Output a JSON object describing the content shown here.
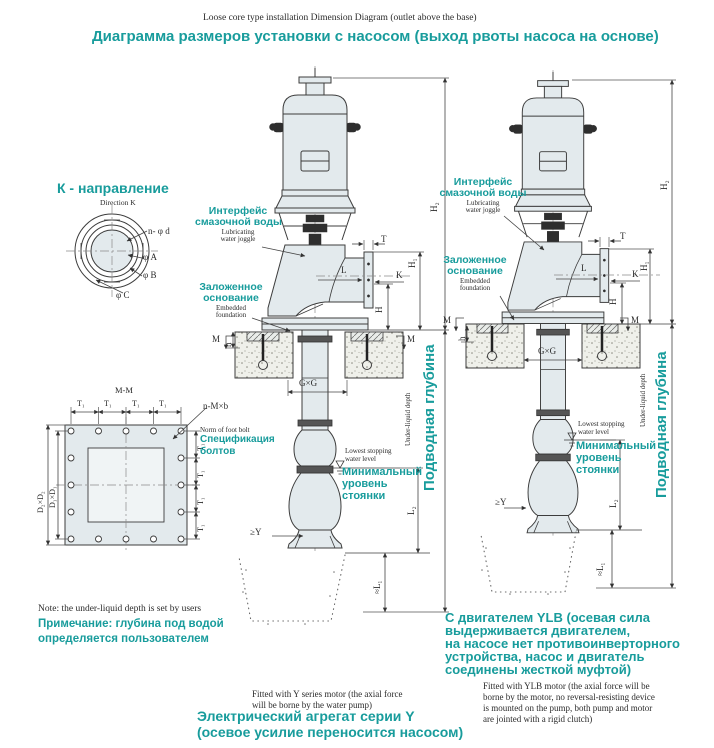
{
  "colors": {
    "accent": "#189c9c",
    "line": "#3c3c3c"
  },
  "title": {
    "en": "Loose core type installation Dimension Diagram (outlet above the base)",
    "ru": "Диаграмма размеров установки с насосом (выход рвоты насоса на основе)"
  },
  "direction_view": {
    "heading_ru": "К - направление",
    "heading_en": "Direction K",
    "bolt_holes": "n- φ d",
    "dia_a": "φ A",
    "dia_b": "φ B",
    "dia_c": "φ C"
  },
  "plan_view": {
    "heading": "M-M",
    "t1": "T₁",
    "d2d2": "D₂×D₂",
    "d1d1": "D₁×D₁",
    "bolt_callout": "n-M×b",
    "bolt_norm_en": "Norm of foot bolt",
    "bolt_norm_ru_1": "Спецификация",
    "bolt_norm_ru_2": "болтов"
  },
  "note": {
    "en": "Note: the under-liquid depth is set by users",
    "ru_1": "Примечание: глубина под водой",
    "ru_2": "определяется пользователем"
  },
  "labels": {
    "lube_ru_1": "Интерфейс",
    "lube_ru_2": "смазочной воды",
    "lube_en_1": "Lubricating",
    "lube_en_2": "water joggle",
    "found_ru_1": "Заложенное",
    "found_ru_2": "основание",
    "found_en_1": "Embedded",
    "found_en_2": "foundation",
    "lowest_en_1": "Lowest stopping",
    "lowest_en_2": "water level",
    "lowest_ru_1": "Минимальный",
    "lowest_ru_2": "уровень",
    "lowest_ru_3": "стоянки",
    "depth_en": "Under-liquid depth",
    "depth_ru": "Подводная глубина"
  },
  "dims": {
    "T": "T",
    "K": "K",
    "L": "L",
    "H": "H",
    "M": "M",
    "h": "h",
    "H1": "H₁",
    "H2": "H₂",
    "L2": "L₂",
    "L1": "≈L₁",
    "GG": "G×G",
    "geY": "≥Y"
  },
  "caption_y": {
    "en_1": "Fitted with Y series motor (the axial force",
    "en_2": "will be borne by the water pump)",
    "ru_1": "Электрический агрегат серии Y",
    "ru_2": "(осевое усилие переносится насосом)"
  },
  "caption_ylb": {
    "ru_1": "С двигателем YLB (осевая сила",
    "ru_2": "выдерживается двигателем,",
    "ru_3": "на насосе нет противоинверторного",
    "ru_4": "устройства, насос и двигатель",
    "ru_5": "соединены жесткой муфтой)",
    "en_1": "Fitted with YLB motor (the axial force will be",
    "en_2": "borne by the motor, no reversal-resisting device",
    "en_3": "is mounted on the pump, both pump and motor",
    "en_4": "are jointed with a rigid clutch)"
  }
}
